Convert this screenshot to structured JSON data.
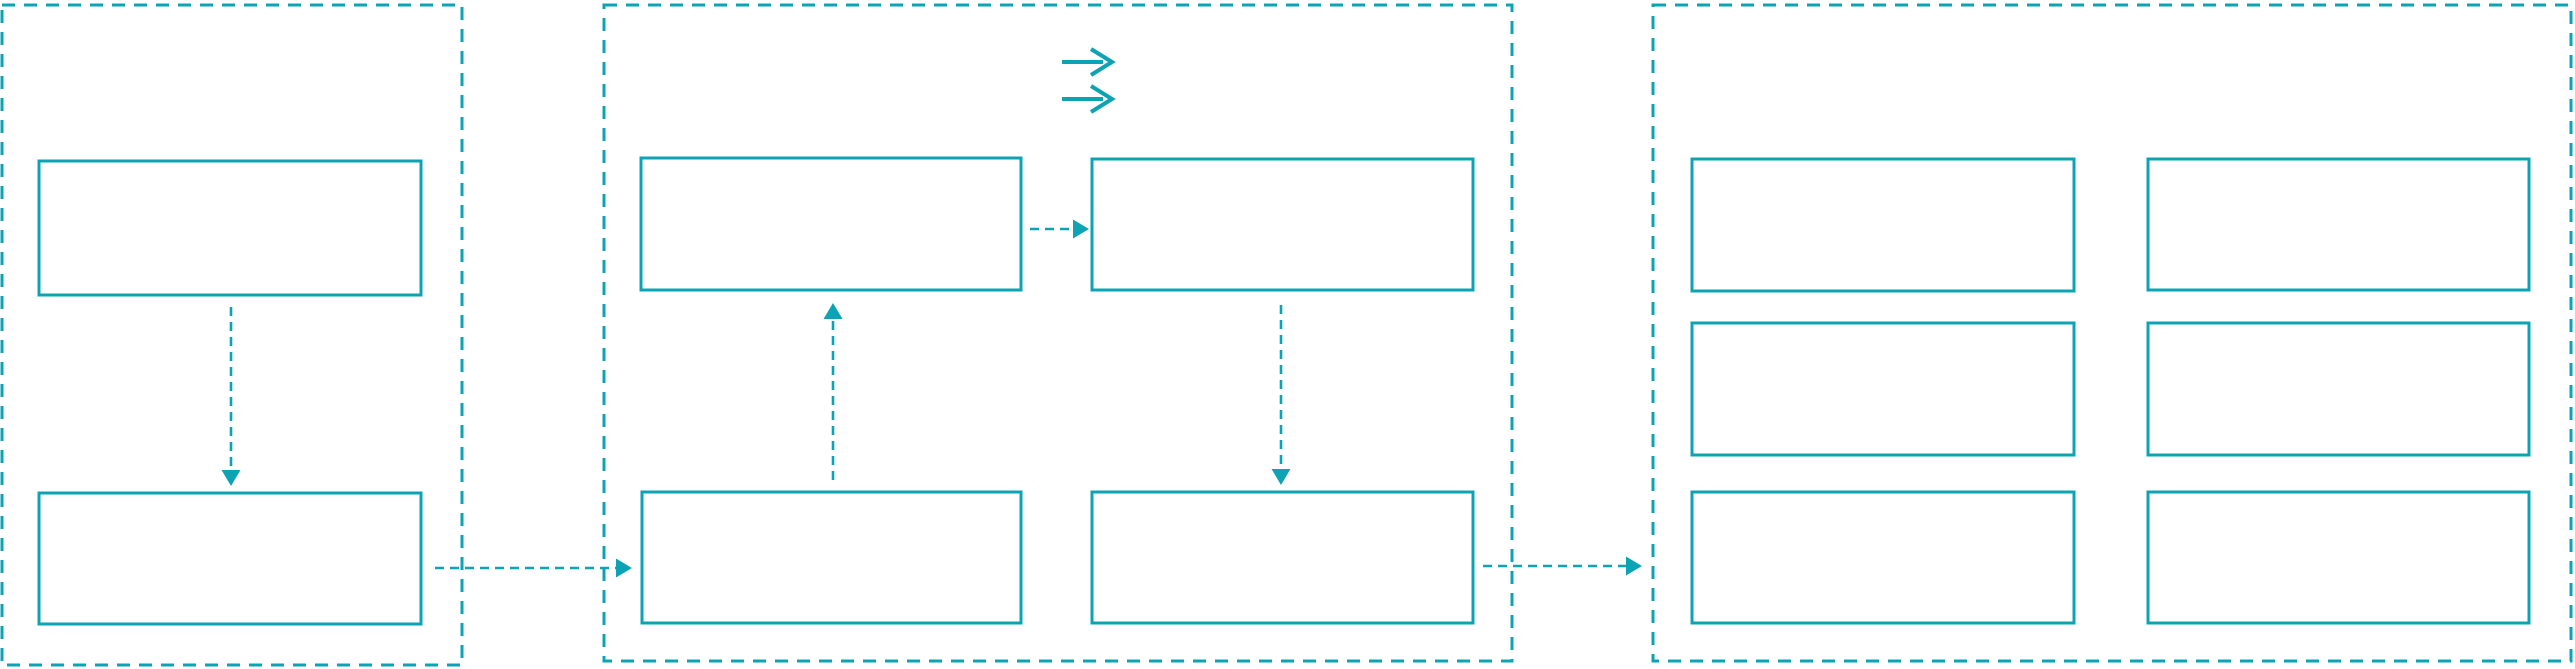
{
  "colors": {
    "stroke": "#0CA4B4",
    "background": "#FFFFFF"
  },
  "diagram": {
    "canvas": {
      "width": 2575,
      "height": 669
    },
    "containers": [
      {
        "id": "left-panel-outline",
        "x": 2,
        "y": 5,
        "w": 460,
        "h": 660
      },
      {
        "id": "middle-panel-outline",
        "x": 604,
        "y": 5,
        "w": 908,
        "h": 656
      },
      {
        "id": "right-panel-outline",
        "x": 1653,
        "y": 5,
        "w": 918,
        "h": 656
      }
    ],
    "boxes": [
      {
        "id": "left-top-box",
        "x": 39,
        "y": 161,
        "w": 382,
        "h": 134
      },
      {
        "id": "left-bottom-box",
        "x": 39,
        "y": 493,
        "w": 382,
        "h": 131
      },
      {
        "id": "middle-top-left-box",
        "x": 641,
        "y": 158,
        "w": 380,
        "h": 132
      },
      {
        "id": "middle-top-right-box",
        "x": 1092,
        "y": 159,
        "w": 381,
        "h": 131
      },
      {
        "id": "middle-bottom-left-box",
        "x": 642,
        "y": 492,
        "w": 379,
        "h": 131
      },
      {
        "id": "middle-bottom-right-box",
        "x": 1092,
        "y": 492,
        "w": 381,
        "h": 131
      },
      {
        "id": "right-row1-left-box",
        "x": 1692,
        "y": 159,
        "w": 382,
        "h": 132
      },
      {
        "id": "right-row1-right-box",
        "x": 2148,
        "y": 159,
        "w": 381,
        "h": 131
      },
      {
        "id": "right-row2-left-box",
        "x": 1692,
        "y": 323,
        "w": 382,
        "h": 132
      },
      {
        "id": "right-row2-right-box",
        "x": 2148,
        "y": 323,
        "w": 381,
        "h": 132
      },
      {
        "id": "right-row3-left-box",
        "x": 1692,
        "y": 492,
        "w": 382,
        "h": 131
      },
      {
        "id": "right-row3-right-box",
        "x": 2148,
        "y": 492,
        "w": 381,
        "h": 131
      }
    ],
    "connectors": [
      {
        "id": "left-top-to-bottom-arrow",
        "x1": 231,
        "y1": 307,
        "x2": 231,
        "y2": 486
      },
      {
        "id": "left-to-middle-arrow",
        "x1": 435,
        "y1": 568,
        "x2": 632,
        "y2": 568
      },
      {
        "id": "middle-bottom-left-to-top-left-arrow",
        "x1": 833,
        "y1": 480,
        "x2": 833,
        "y2": 303
      },
      {
        "id": "middle-top-left-to-top-right-arrow",
        "x1": 1030,
        "y1": 229,
        "x2": 1089,
        "y2": 229
      },
      {
        "id": "middle-top-right-to-bottom-right-arrow",
        "x1": 1281,
        "y1": 305,
        "x2": 1281,
        "y2": 485
      },
      {
        "id": "middle-to-right-arrow",
        "x1": 1483,
        "y1": 566,
        "x2": 1642,
        "y2": 566
      }
    ],
    "glyphs": [
      {
        "id": "double-flow-arrow-top-icon",
        "x": 1062,
        "y": 62
      },
      {
        "id": "double-flow-arrow-bottom-icon",
        "x": 1062,
        "y": 99
      }
    ],
    "style": {
      "container_stroke_width": 3,
      "container_dasharray": "13 9",
      "box_stroke_width": 3,
      "connector_stroke_width": 2.6,
      "connector_dasharray": "9 6",
      "arrowhead_length": 16,
      "arrowhead_half_width": 9.5,
      "glyph_stroke_width": 4
    }
  }
}
